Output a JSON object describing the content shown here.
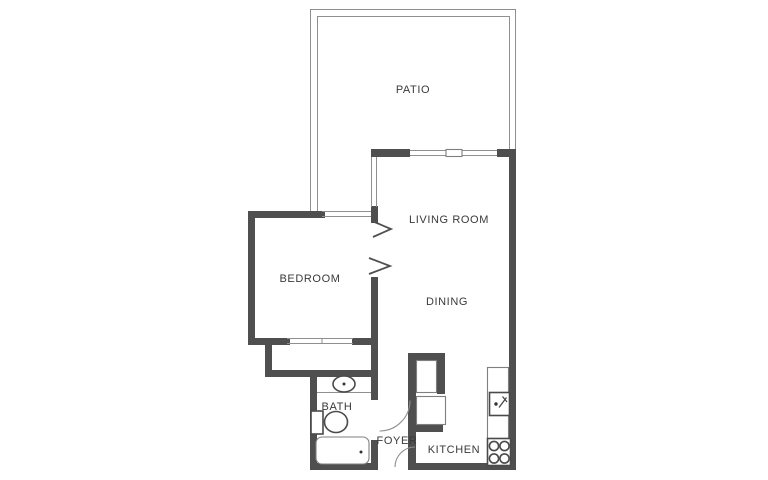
{
  "plan": {
    "type": "apartment-floor-plan",
    "colors": {
      "background": "#ffffff",
      "wall": "#4f4f4f",
      "thin_line": "#8f8f8f",
      "label_text": "#3a3a3a"
    },
    "rooms": [
      {
        "id": "patio",
        "label": "PATIO"
      },
      {
        "id": "living-room",
        "label": "LIVING ROOM"
      },
      {
        "id": "dining",
        "label": "DINING"
      },
      {
        "id": "bedroom",
        "label": "BEDROOM"
      },
      {
        "id": "bath",
        "label": "BATH"
      },
      {
        "id": "foyer",
        "label": "FOYER"
      },
      {
        "id": "kitchen",
        "label": "KITCHEN"
      }
    ],
    "fixtures": [
      "bathroom-sink",
      "toilet",
      "bathtub",
      "kitchen-sink",
      "stove",
      "counter",
      "refrigerator",
      "appliance-closet"
    ],
    "doors": [
      "bedroom-double-door-chevrons",
      "bath-door-swing",
      "entry-door-swing"
    ],
    "windows": [
      "bedroom-window",
      "living-room-side-window",
      "living-room-slider",
      "bedroom-closet-sliding-doors"
    ]
  }
}
